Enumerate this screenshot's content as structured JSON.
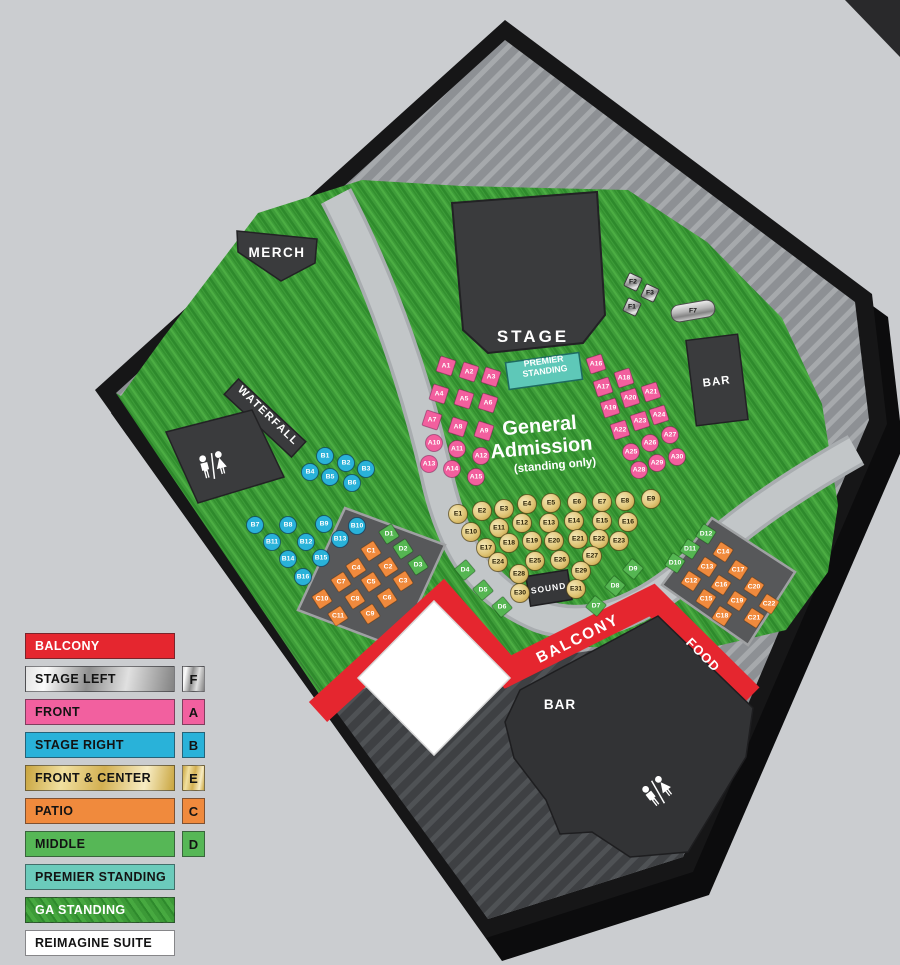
{
  "legend": {
    "items": [
      {
        "label": "BALCONY",
        "swatch": "red",
        "badge": ""
      },
      {
        "label": "STAGE LEFT",
        "swatch": "silver",
        "badge": "F"
      },
      {
        "label": "FRONT",
        "swatch": "pink",
        "badge": "A"
      },
      {
        "label": "STAGE RIGHT",
        "swatch": "cyan",
        "badge": "B"
      },
      {
        "label": "FRONT & CENTER",
        "swatch": "gold",
        "badge": "E"
      },
      {
        "label": "PATIO",
        "swatch": "orange",
        "badge": "C"
      },
      {
        "label": "MIDDLE",
        "swatch": "green",
        "badge": "D"
      },
      {
        "label": "PREMIER STANDING",
        "swatch": "teal",
        "badge": ""
      },
      {
        "label": "GA STANDING",
        "swatch": "grass",
        "badge": ""
      },
      {
        "label": "REIMAGINE SUITE",
        "swatch": "white",
        "badge": ""
      }
    ]
  },
  "map": {
    "areas": {
      "stage": "STAGE",
      "merch": "MERCH",
      "waterfall": "WATERFALL",
      "premier_line1": "PREMIER",
      "premier_line2": "STANDING",
      "ga_line1": "General",
      "ga_line2": "Admission",
      "ga_line3": "(standing only)",
      "sound": "SOUND",
      "balcony": "BALCONY",
      "food": "FOOD",
      "bar_north": "BAR",
      "bar_south": "BAR",
      "suite_line1": "REIMAGINE",
      "suite_line2": "SUITE",
      "suite_line3": "(DOWNSTAIRS)"
    },
    "colors": {
      "balcony_red": "#e5262f",
      "front_pink": "#f25f9e",
      "stage_right_cyan": "#29b2d9",
      "front_center_gold": "#e0c678",
      "patio_orange": "#f08a3d",
      "middle_green": "#55b652",
      "premier_teal": "#6bcbbb",
      "stage_left_silver": "#c7c7c7"
    },
    "tables": [
      {
        "id": "A1",
        "t": "sq",
        "c": "pink",
        "x": 446,
        "y": 366,
        "r": 18
      },
      {
        "id": "A2",
        "t": "sq",
        "c": "pink",
        "x": 469,
        "y": 372,
        "r": 18
      },
      {
        "id": "A3",
        "t": "sq",
        "c": "pink",
        "x": 491,
        "y": 377,
        "r": 18
      },
      {
        "id": "A4",
        "t": "sq",
        "c": "pink",
        "x": 439,
        "y": 394,
        "r": 18
      },
      {
        "id": "A5",
        "t": "sq",
        "c": "pink",
        "x": 464,
        "y": 399,
        "r": 18
      },
      {
        "id": "A6",
        "t": "sq",
        "c": "pink",
        "x": 488,
        "y": 403,
        "r": 18
      },
      {
        "id": "A7",
        "t": "sq",
        "c": "pink",
        "x": 432,
        "y": 420,
        "r": 18
      },
      {
        "id": "A8",
        "t": "sq",
        "c": "pink",
        "x": 458,
        "y": 427,
        "r": 18
      },
      {
        "id": "A9",
        "t": "sq",
        "c": "pink",
        "x": 484,
        "y": 431,
        "r": 18
      },
      {
        "id": "A10",
        "t": "c",
        "c": "pink",
        "x": 434,
        "y": 443,
        "r": 0
      },
      {
        "id": "A11",
        "t": "c",
        "c": "pink",
        "x": 457,
        "y": 449,
        "r": 0
      },
      {
        "id": "A12",
        "t": "c",
        "c": "pink",
        "x": 481,
        "y": 456,
        "r": 0
      },
      {
        "id": "A13",
        "t": "c",
        "c": "pink",
        "x": 429,
        "y": 464,
        "r": 0
      },
      {
        "id": "A14",
        "t": "c",
        "c": "pink",
        "x": 452,
        "y": 469,
        "r": 0
      },
      {
        "id": "A15",
        "t": "c",
        "c": "pink",
        "x": 476,
        "y": 477,
        "r": 0
      },
      {
        "id": "A16",
        "t": "sq",
        "c": "pink",
        "x": 596,
        "y": 364,
        "r": -18
      },
      {
        "id": "A17",
        "t": "sq",
        "c": "pink",
        "x": 603,
        "y": 387,
        "r": -18
      },
      {
        "id": "A18",
        "t": "sq",
        "c": "pink",
        "x": 624,
        "y": 378,
        "r": -18
      },
      {
        "id": "A19",
        "t": "sq",
        "c": "pink",
        "x": 610,
        "y": 408,
        "r": -18
      },
      {
        "id": "A20",
        "t": "sq",
        "c": "pink",
        "x": 630,
        "y": 398,
        "r": -18
      },
      {
        "id": "A21",
        "t": "sq",
        "c": "pink",
        "x": 651,
        "y": 392,
        "r": -18
      },
      {
        "id": "A22",
        "t": "sq",
        "c": "pink",
        "x": 620,
        "y": 430,
        "r": -18
      },
      {
        "id": "A23",
        "t": "sq",
        "c": "pink",
        "x": 640,
        "y": 421,
        "r": -18
      },
      {
        "id": "A24",
        "t": "sq",
        "c": "pink",
        "x": 659,
        "y": 415,
        "r": -18
      },
      {
        "id": "A25",
        "t": "c",
        "c": "pink",
        "x": 631,
        "y": 452,
        "r": 0
      },
      {
        "id": "A26",
        "t": "c",
        "c": "pink",
        "x": 650,
        "y": 443,
        "r": 0
      },
      {
        "id": "A27",
        "t": "c",
        "c": "pink",
        "x": 670,
        "y": 435,
        "r": 0
      },
      {
        "id": "A28",
        "t": "c",
        "c": "pink",
        "x": 639,
        "y": 470,
        "r": 0
      },
      {
        "id": "A29",
        "t": "c",
        "c": "pink",
        "x": 657,
        "y": 463,
        "r": 0
      },
      {
        "id": "A30",
        "t": "c",
        "c": "pink",
        "x": 677,
        "y": 457,
        "r": 0
      },
      {
        "id": "B1",
        "t": "c",
        "c": "cyan",
        "x": 325,
        "y": 456,
        "r": 0
      },
      {
        "id": "B2",
        "t": "c",
        "c": "cyan",
        "x": 346,
        "y": 463,
        "r": 0
      },
      {
        "id": "B3",
        "t": "c",
        "c": "cyan",
        "x": 366,
        "y": 469,
        "r": 0
      },
      {
        "id": "B4",
        "t": "c",
        "c": "cyan",
        "x": 310,
        "y": 472,
        "r": 0
      },
      {
        "id": "B5",
        "t": "c",
        "c": "cyan",
        "x": 330,
        "y": 477,
        "r": 0
      },
      {
        "id": "B6",
        "t": "c",
        "c": "cyan",
        "x": 352,
        "y": 483,
        "r": 0
      },
      {
        "id": "B7",
        "t": "c",
        "c": "cyan",
        "x": 255,
        "y": 525,
        "r": 0
      },
      {
        "id": "B8",
        "t": "c",
        "c": "cyan",
        "x": 288,
        "y": 525,
        "r": 0
      },
      {
        "id": "B9",
        "t": "c",
        "c": "cyan",
        "x": 324,
        "y": 524,
        "r": 0
      },
      {
        "id": "B10",
        "t": "c",
        "c": "cyan",
        "x": 357,
        "y": 526,
        "r": 0
      },
      {
        "id": "B11",
        "t": "c",
        "c": "cyan",
        "x": 272,
        "y": 542,
        "r": 0
      },
      {
        "id": "B12",
        "t": "c",
        "c": "cyan",
        "x": 306,
        "y": 542,
        "r": 0
      },
      {
        "id": "B13",
        "t": "c",
        "c": "cyan",
        "x": 340,
        "y": 539,
        "r": 0
      },
      {
        "id": "B14",
        "t": "c",
        "c": "cyan",
        "x": 288,
        "y": 559,
        "r": 0
      },
      {
        "id": "B15",
        "t": "c",
        "c": "cyan",
        "x": 321,
        "y": 558,
        "r": 0
      },
      {
        "id": "B16",
        "t": "c",
        "c": "cyan",
        "x": 303,
        "y": 577,
        "r": 0
      },
      {
        "id": "D1",
        "t": "d",
        "c": "green",
        "x": 389,
        "y": 534,
        "r": 57
      },
      {
        "id": "D2",
        "t": "d",
        "c": "green",
        "x": 403,
        "y": 549,
        "r": 57
      },
      {
        "id": "D3",
        "t": "d",
        "c": "green",
        "x": 418,
        "y": 565,
        "r": 57
      },
      {
        "id": "C1",
        "t": "d",
        "c": "orange",
        "x": 371,
        "y": 551,
        "r": 57
      },
      {
        "id": "C2",
        "t": "d",
        "c": "orange",
        "x": 388,
        "y": 567,
        "r": 57
      },
      {
        "id": "C3",
        "t": "d",
        "c": "orange",
        "x": 403,
        "y": 581,
        "r": 57
      },
      {
        "id": "C4",
        "t": "d",
        "c": "orange",
        "x": 356,
        "y": 568,
        "r": 57
      },
      {
        "id": "C5",
        "t": "d",
        "c": "orange",
        "x": 371,
        "y": 582,
        "r": 57
      },
      {
        "id": "C6",
        "t": "d",
        "c": "orange",
        "x": 387,
        "y": 598,
        "r": 57
      },
      {
        "id": "C7",
        "t": "d",
        "c": "orange",
        "x": 341,
        "y": 582,
        "r": 57
      },
      {
        "id": "C8",
        "t": "d",
        "c": "orange",
        "x": 355,
        "y": 599,
        "r": 57
      },
      {
        "id": "C9",
        "t": "d",
        "c": "orange",
        "x": 370,
        "y": 614,
        "r": 57
      },
      {
        "id": "C10",
        "t": "d",
        "c": "orange",
        "x": 322,
        "y": 599,
        "r": 57
      },
      {
        "id": "C11",
        "t": "d",
        "c": "orange",
        "x": 338,
        "y": 616,
        "r": 57
      },
      {
        "id": "D4",
        "t": "d",
        "c": "green",
        "x": 465,
        "y": 570,
        "r": 50
      },
      {
        "id": "D5",
        "t": "d",
        "c": "green",
        "x": 483,
        "y": 590,
        "r": 50
      },
      {
        "id": "D6",
        "t": "d",
        "c": "green",
        "x": 502,
        "y": 607,
        "r": 50
      },
      {
        "id": "D7",
        "t": "d",
        "c": "green",
        "x": 596,
        "y": 606,
        "r": 40
      },
      {
        "id": "D8",
        "t": "d",
        "c": "green",
        "x": 615,
        "y": 586,
        "r": 40
      },
      {
        "id": "D9",
        "t": "d",
        "c": "green",
        "x": 633,
        "y": 569,
        "r": 40
      },
      {
        "id": "D10",
        "t": "d",
        "c": "green",
        "x": 675,
        "y": 563,
        "r": 33
      },
      {
        "id": "D11",
        "t": "d",
        "c": "green",
        "x": 690,
        "y": 549,
        "r": 33
      },
      {
        "id": "D12",
        "t": "d",
        "c": "green",
        "x": 706,
        "y": 534,
        "r": 33
      },
      {
        "id": "C12",
        "t": "d",
        "c": "orange",
        "x": 691,
        "y": 581,
        "r": 33
      },
      {
        "id": "C13",
        "t": "d",
        "c": "orange",
        "x": 707,
        "y": 567,
        "r": 33
      },
      {
        "id": "C14",
        "t": "d",
        "c": "orange",
        "x": 723,
        "y": 552,
        "r": 33
      },
      {
        "id": "C15",
        "t": "d",
        "c": "orange",
        "x": 706,
        "y": 599,
        "r": 33
      },
      {
        "id": "C16",
        "t": "d",
        "c": "orange",
        "x": 721,
        "y": 585,
        "r": 33
      },
      {
        "id": "C17",
        "t": "d",
        "c": "orange",
        "x": 738,
        "y": 570,
        "r": 33
      },
      {
        "id": "C18",
        "t": "d",
        "c": "orange",
        "x": 722,
        "y": 616,
        "r": 33
      },
      {
        "id": "C19",
        "t": "d",
        "c": "orange",
        "x": 737,
        "y": 601,
        "r": 33
      },
      {
        "id": "C20",
        "t": "d",
        "c": "orange",
        "x": 754,
        "y": 587,
        "r": 33
      },
      {
        "id": "C21",
        "t": "d",
        "c": "orange",
        "x": 754,
        "y": 618,
        "r": 33
      },
      {
        "id": "C22",
        "t": "d",
        "c": "orange",
        "x": 769,
        "y": 604,
        "r": 33
      },
      {
        "id": "E1",
        "t": "c",
        "c": "gold",
        "x": 458,
        "y": 514,
        "r": 0
      },
      {
        "id": "E2",
        "t": "c",
        "c": "gold",
        "x": 482,
        "y": 511,
        "r": 0
      },
      {
        "id": "E3",
        "t": "c",
        "c": "gold",
        "x": 504,
        "y": 509,
        "r": 0
      },
      {
        "id": "E4",
        "t": "c",
        "c": "gold",
        "x": 527,
        "y": 504,
        "r": 0
      },
      {
        "id": "E5",
        "t": "c",
        "c": "gold",
        "x": 551,
        "y": 503,
        "r": 0
      },
      {
        "id": "E6",
        "t": "c",
        "c": "gold",
        "x": 577,
        "y": 502,
        "r": 0
      },
      {
        "id": "E7",
        "t": "c",
        "c": "gold",
        "x": 602,
        "y": 502,
        "r": 0
      },
      {
        "id": "E8",
        "t": "c",
        "c": "gold",
        "x": 625,
        "y": 501,
        "r": 0
      },
      {
        "id": "E9",
        "t": "c",
        "c": "gold",
        "x": 651,
        "y": 499,
        "r": 0
      },
      {
        "id": "E10",
        "t": "c",
        "c": "gold",
        "x": 471,
        "y": 532,
        "r": 0
      },
      {
        "id": "E11",
        "t": "c",
        "c": "gold",
        "x": 499,
        "y": 528,
        "r": 0
      },
      {
        "id": "E12",
        "t": "c",
        "c": "gold",
        "x": 522,
        "y": 523,
        "r": 0
      },
      {
        "id": "E13",
        "t": "c",
        "c": "gold",
        "x": 549,
        "y": 523,
        "r": 0
      },
      {
        "id": "E14",
        "t": "c",
        "c": "gold",
        "x": 574,
        "y": 521,
        "r": 0
      },
      {
        "id": "E15",
        "t": "c",
        "c": "gold",
        "x": 602,
        "y": 521,
        "r": 0
      },
      {
        "id": "E16",
        "t": "c",
        "c": "gold",
        "x": 628,
        "y": 522,
        "r": 0
      },
      {
        "id": "E17",
        "t": "c",
        "c": "gold",
        "x": 486,
        "y": 548,
        "r": 0
      },
      {
        "id": "E18",
        "t": "c",
        "c": "gold",
        "x": 509,
        "y": 543,
        "r": 0
      },
      {
        "id": "E19",
        "t": "c",
        "c": "gold",
        "x": 532,
        "y": 541,
        "r": 0
      },
      {
        "id": "E20",
        "t": "c",
        "c": "gold",
        "x": 554,
        "y": 541,
        "r": 0
      },
      {
        "id": "E21",
        "t": "c",
        "c": "gold",
        "x": 578,
        "y": 539,
        "r": 0
      },
      {
        "id": "E22",
        "t": "c",
        "c": "gold",
        "x": 599,
        "y": 539,
        "r": 0
      },
      {
        "id": "E23",
        "t": "c",
        "c": "gold",
        "x": 619,
        "y": 541,
        "r": 0
      },
      {
        "id": "E24",
        "t": "c",
        "c": "gold",
        "x": 498,
        "y": 562,
        "r": 0
      },
      {
        "id": "E25",
        "t": "c",
        "c": "gold",
        "x": 535,
        "y": 561,
        "r": 0
      },
      {
        "id": "E26",
        "t": "c",
        "c": "gold",
        "x": 560,
        "y": 560,
        "r": 0
      },
      {
        "id": "E27",
        "t": "c",
        "c": "gold",
        "x": 592,
        "y": 556,
        "r": 0
      },
      {
        "id": "E28",
        "t": "c",
        "c": "gold",
        "x": 519,
        "y": 574,
        "r": 0
      },
      {
        "id": "E29",
        "t": "c",
        "c": "gold",
        "x": 581,
        "y": 571,
        "r": 0
      },
      {
        "id": "E30",
        "t": "c",
        "c": "gold",
        "x": 520,
        "y": 593,
        "r": 0
      },
      {
        "id": "E31",
        "t": "c",
        "c": "gold",
        "x": 576,
        "y": 589,
        "r": 0
      },
      {
        "id": "F1",
        "t": "sd",
        "c": "silver",
        "x": 632,
        "y": 307,
        "r": 25
      },
      {
        "id": "F2",
        "t": "sd",
        "c": "silver",
        "x": 633,
        "y": 282,
        "r": 25
      },
      {
        "id": "F3",
        "t": "sd",
        "c": "silver",
        "x": 650,
        "y": 293,
        "r": 25
      },
      {
        "id": "F7",
        "t": "cyl",
        "c": "silver",
        "x": 693,
        "y": 311,
        "r": -10
      }
    ]
  }
}
